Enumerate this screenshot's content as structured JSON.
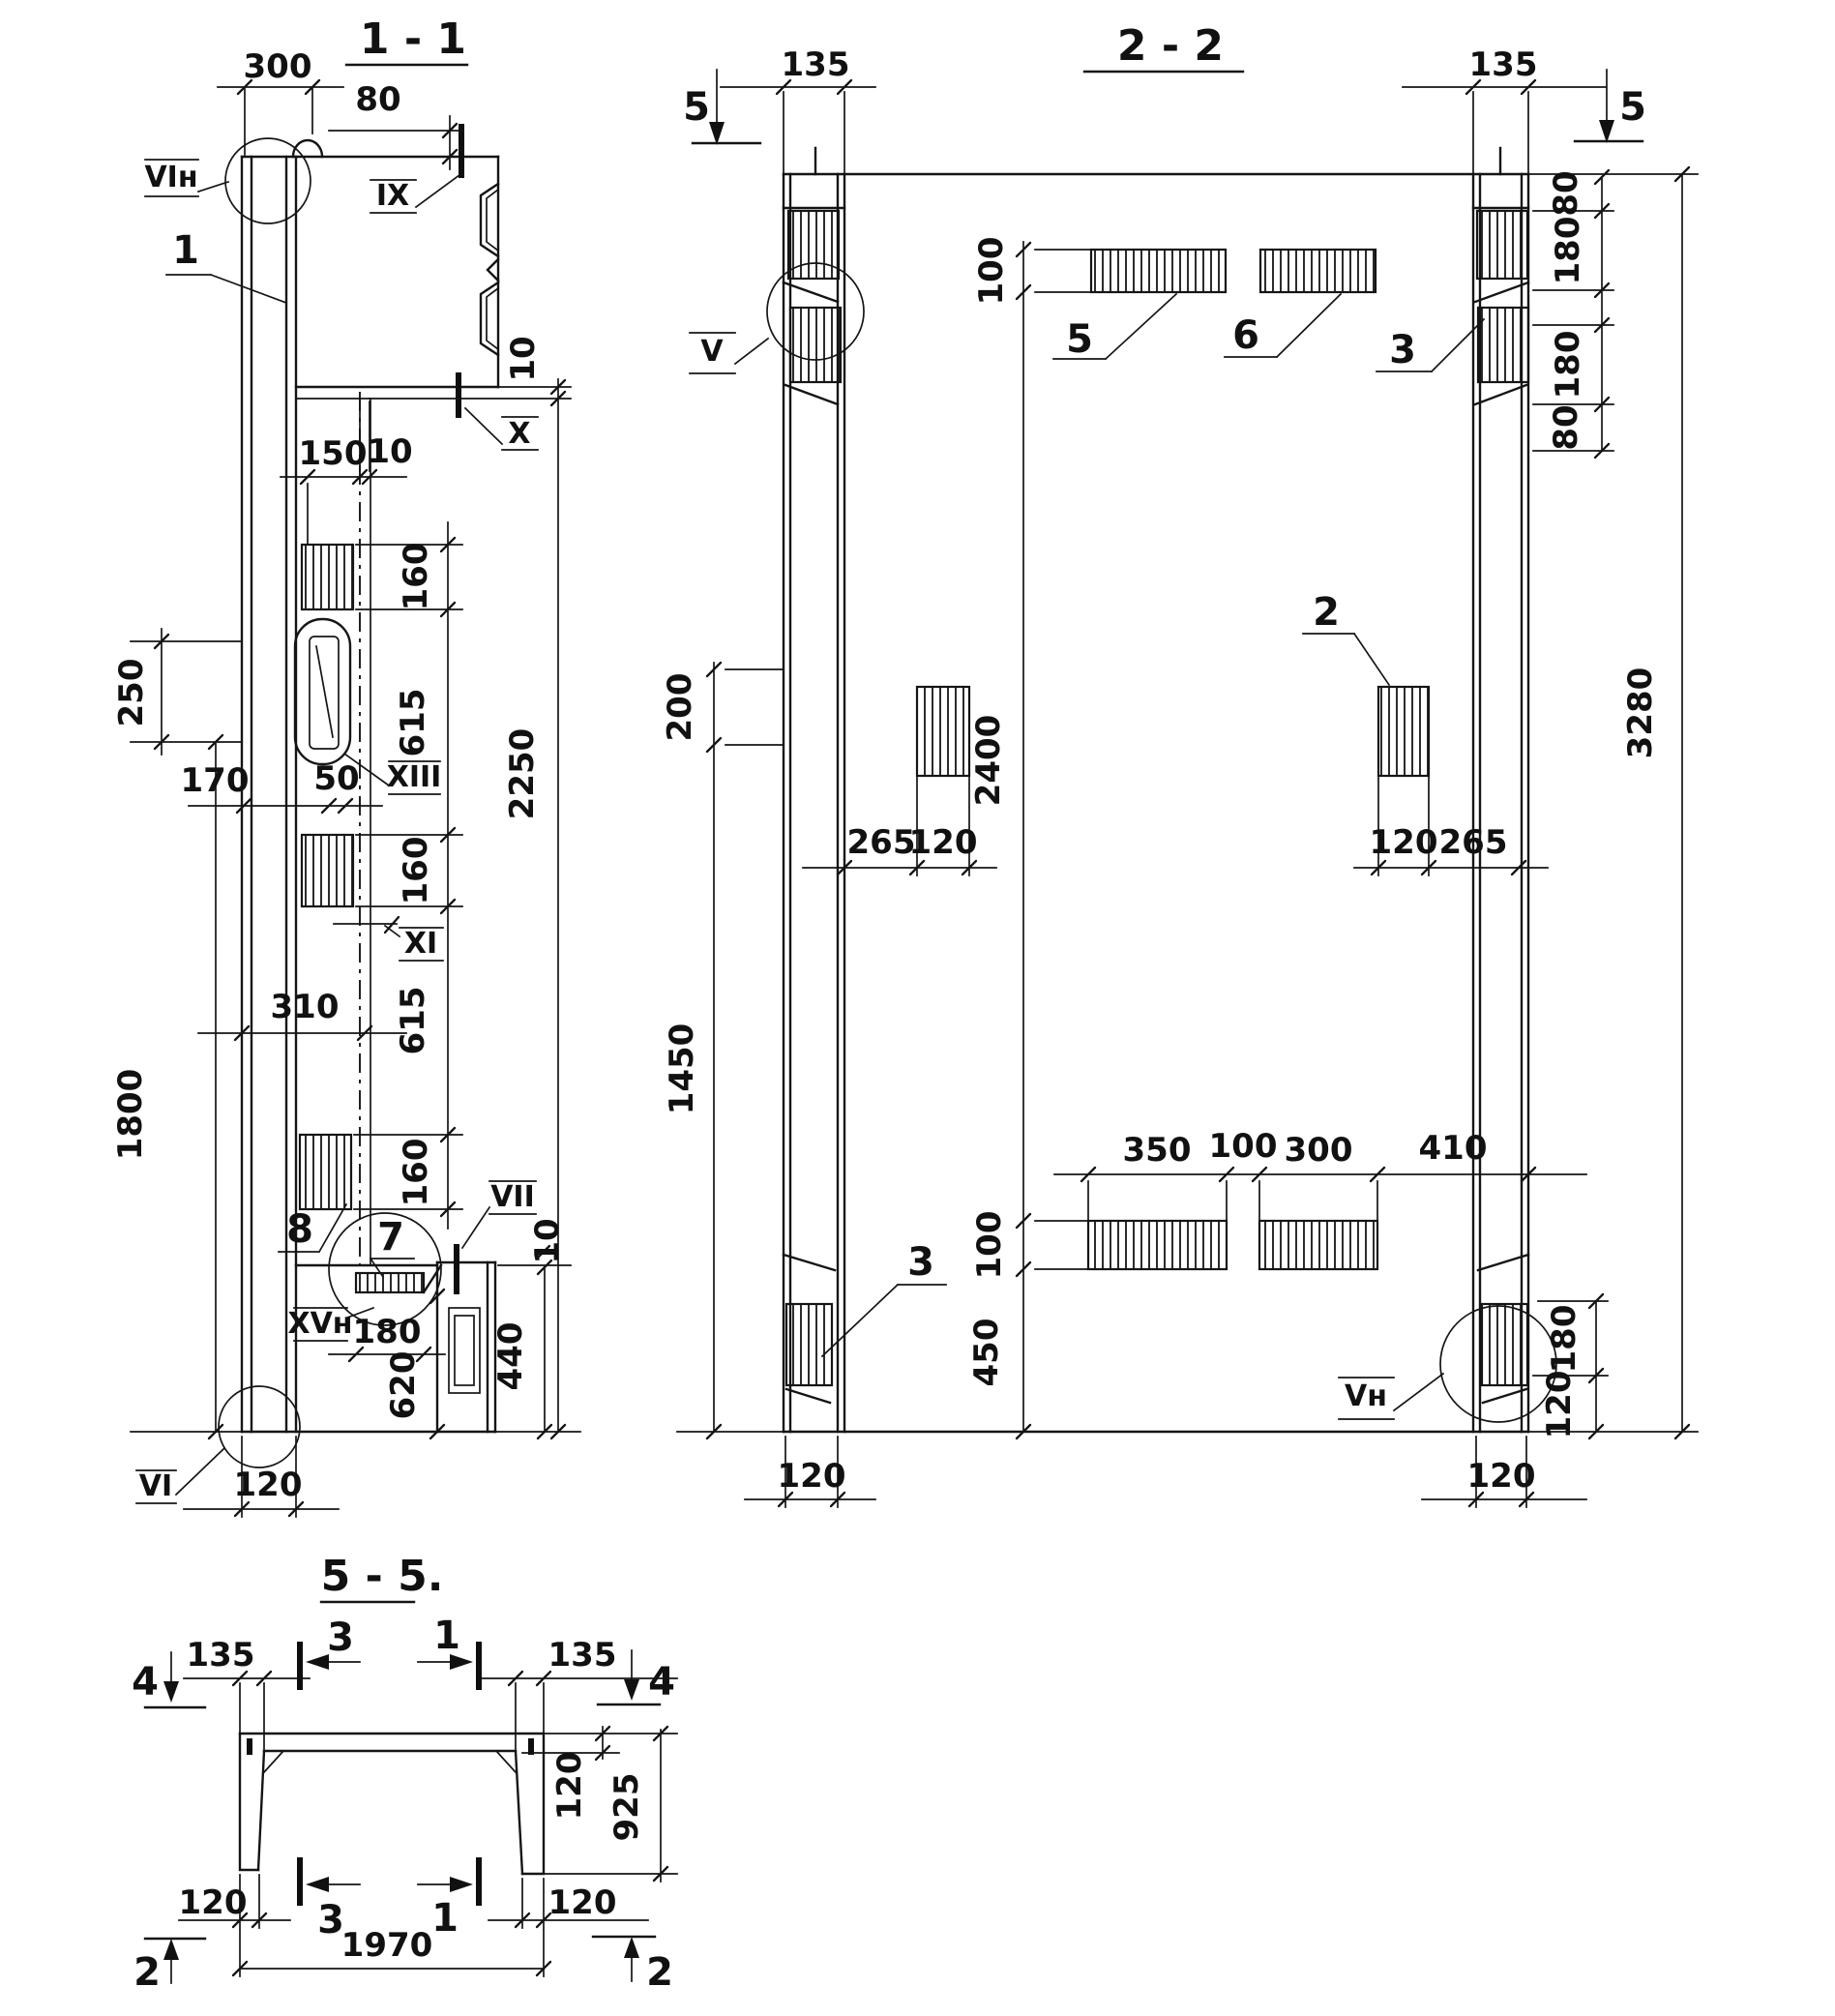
{
  "sections": {
    "s11": {
      "title": "1 - 1",
      "dims": {
        "t300": "300",
        "t80": "80",
        "step10": "10",
        "k150": "150",
        "k10": "10",
        "c160a": "160",
        "c615a": "615",
        "c160b": "160",
        "c615b": "615",
        "c160c": "160",
        "l250": "250",
        "l170": "170",
        "l50": "50",
        "l310": "310",
        "l1800": "1800",
        "r2250": "2250",
        "b180": "180",
        "b620": "620",
        "b440": "440",
        "b10": "10",
        "b120": "120"
      },
      "callouts": {
        "vin": "VIн",
        "ix": "IX",
        "x": "X",
        "xiii": "XIII",
        "xi": "XI",
        "vii": "VII",
        "xvn": "XVн",
        "vi": "VI"
      },
      "parts": {
        "p1": "1",
        "p8": "8",
        "p7": "7"
      }
    },
    "s22": {
      "title": "2 - 2",
      "dims": {
        "l135": "135",
        "r135": "135",
        "c100t": "100",
        "c2400": "2400",
        "c100b": "100",
        "c450": "450",
        "l200": "200",
        "l1450": "1450",
        "r80a": "80",
        "r180a": "180",
        "r180b": "180",
        "r80b": "80",
        "r3280": "3280",
        "ml265": "265",
        "ml120": "120",
        "mr120": "120",
        "mr265": "265",
        "b350": "350",
        "b100": "100",
        "b300": "300",
        "b410": "410",
        "bl120": "120",
        "br120": "120",
        "br180": "180",
        "brv120": "120"
      },
      "callouts": {
        "v": "V",
        "vn": "Vн"
      },
      "parts": {
        "p5": "5",
        "p6": "6",
        "p3t": "3",
        "p2": "2",
        "p3b": "3"
      },
      "marks": {
        "s5l": "5",
        "s5r": "5"
      }
    },
    "s55": {
      "title": "5 - 5.",
      "dims": {
        "l135": "135",
        "r135": "135",
        "bl120": "120",
        "br120": "120",
        "b1970": "1970",
        "rv120": "120",
        "rv925": "925"
      },
      "marks": {
        "m4l": "4",
        "m4r": "4",
        "m3t": "3",
        "m1t": "1",
        "m3b": "3",
        "m1b": "1",
        "m2l": "2",
        "m2r": "2"
      }
    }
  }
}
